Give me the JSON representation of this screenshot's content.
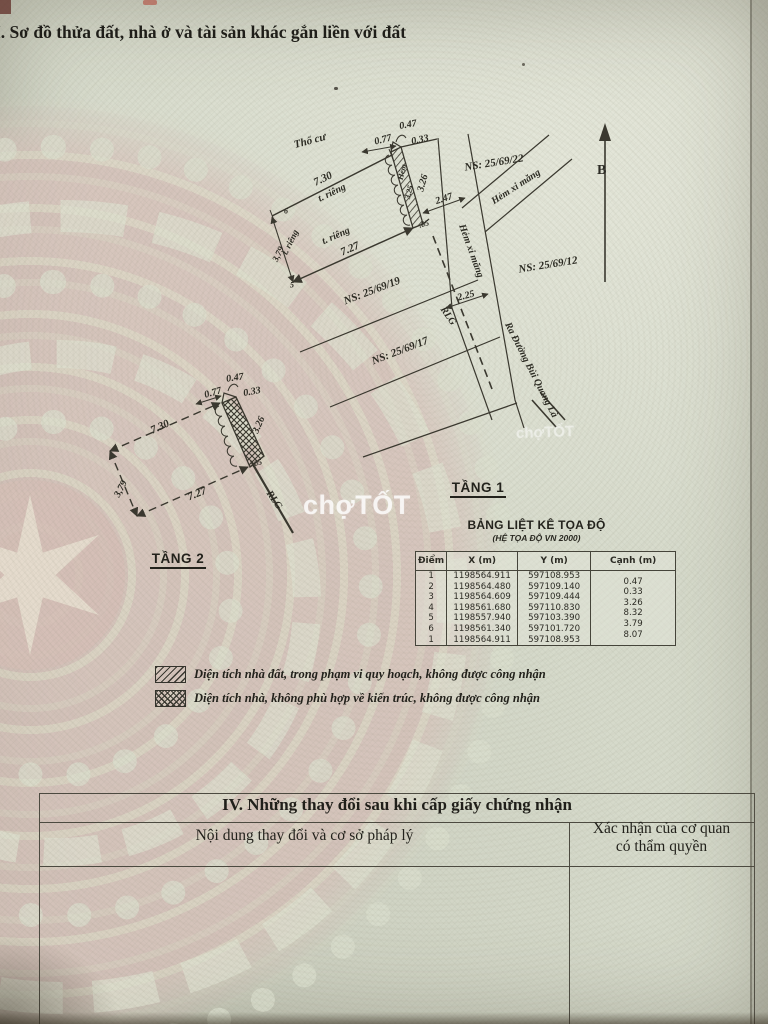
{
  "title_section1": "I. Sơ đồ thửa đất, nhà ở và tài sản khác gắn liền với đất",
  "north_label": "B",
  "floor1": {
    "label": "TẦNG 1",
    "annotations": [
      {
        "t": "Thổ cư",
        "x": 310,
        "y": 141,
        "r": -15,
        "fs": 11
      },
      {
        "t": "0.77",
        "x": 383,
        "y": 140,
        "r": -15,
        "fs": 10
      },
      {
        "t": "0.47",
        "x": 408,
        "y": 125,
        "r": -10,
        "fs": 10
      },
      {
        "t": "0.33",
        "x": 420,
        "y": 140,
        "r": -12,
        "fs": 10
      },
      {
        "t": "7.30",
        "x": 323,
        "y": 179,
        "r": -26,
        "fs": 11
      },
      {
        "t": "t. riêng",
        "x": 332,
        "y": 193,
        "r": -26,
        "fs": 10
      },
      {
        "t": "t. riêng",
        "x": 290,
        "y": 242,
        "r": -64,
        "fs": 9
      },
      {
        "t": "3,79",
        "x": 278,
        "y": 254,
        "r": -64,
        "fs": 9
      },
      {
        "t": "t. riêng",
        "x": 336,
        "y": 236,
        "r": -24,
        "fs": 10
      },
      {
        "t": "7.27",
        "x": 350,
        "y": 249,
        "r": -24,
        "fs": 11
      },
      {
        "t": "Hẻm",
        "x": 402,
        "y": 172,
        "r": -76,
        "fs": 8
      },
      {
        "t": "3.25",
        "x": 409,
        "y": 192,
        "r": -76,
        "fs": 8
      },
      {
        "t": "3.26",
        "x": 423,
        "y": 183,
        "r": -74,
        "fs": 10
      },
      {
        "t": "2.47",
        "x": 444,
        "y": 199,
        "r": -18,
        "fs": 10
      },
      {
        "t": ".05",
        "x": 424,
        "y": 224,
        "r": -15,
        "fs": 8
      },
      {
        "t": "NS: 25/69/19",
        "x": 372,
        "y": 291,
        "r": -21,
        "fs": 11
      },
      {
        "t": "NS: 25/69/17",
        "x": 400,
        "y": 351,
        "r": -21,
        "fs": 11
      },
      {
        "t": "NS: 25/69/22",
        "x": 494,
        "y": 163,
        "r": -9,
        "fs": 11
      },
      {
        "t": "NS: 25/69/12",
        "x": 548,
        "y": 265,
        "r": -9,
        "fs": 11
      },
      {
        "t": "Hẻm xi măng",
        "x": 516,
        "y": 187,
        "r": -33,
        "fs": 10
      },
      {
        "t": "Hẻm xi măng",
        "x": 471,
        "y": 251,
        "r": 70,
        "fs": 10
      },
      {
        "t": "2.25",
        "x": 466,
        "y": 296,
        "r": -15,
        "fs": 10
      },
      {
        "t": "RLG",
        "x": 448,
        "y": 316,
        "r": 55,
        "fs": 10
      },
      {
        "t": "Ra Đường Bùi Quang Là",
        "x": 531,
        "y": 370,
        "r": 63,
        "fs": 10
      },
      {
        "t": "6",
        "x": 286,
        "y": 211,
        "r": 0,
        "fs": 8
      },
      {
        "t": "5",
        "x": 292,
        "y": 285,
        "r": 0,
        "fs": 8
      }
    ]
  },
  "floor2": {
    "label": "TẦNG 2",
    "annotations": [
      {
        "t": "0.77",
        "x": 213,
        "y": 393,
        "r": -16,
        "fs": 10
      },
      {
        "t": "0.47",
        "x": 235,
        "y": 378,
        "r": -8,
        "fs": 10
      },
      {
        "t": "0.33",
        "x": 252,
        "y": 392,
        "r": -10,
        "fs": 10
      },
      {
        "t": "7.30",
        "x": 160,
        "y": 427,
        "r": -25,
        "fs": 11
      },
      {
        "t": "3.26",
        "x": 259,
        "y": 425,
        "r": -66,
        "fs": 10
      },
      {
        "t": ".05",
        "x": 257,
        "y": 463,
        "r": -15,
        "fs": 8
      },
      {
        "t": "3,79",
        "x": 121,
        "y": 489,
        "r": -62,
        "fs": 10
      },
      {
        "t": "7.27",
        "x": 197,
        "y": 494,
        "r": -22,
        "fs": 11
      },
      {
        "t": "RLG",
        "x": 274,
        "y": 500,
        "r": 55,
        "fs": 10
      }
    ]
  },
  "coord_table": {
    "title": "BẢNG LIỆT KÊ TỌA ĐỘ",
    "subtitle": "(HỆ TỌA ĐỘ VN 2000)",
    "headers": [
      "Điểm",
      "X (m)",
      "Y (m)",
      "Cạnh (m)"
    ],
    "rows": [
      [
        "1",
        "1198564.911",
        "597108.953",
        ""
      ],
      [
        "2",
        "1198564.480",
        "597109.140",
        "0.47"
      ],
      [
        "3",
        "1198564.609",
        "597109.444",
        "0.33"
      ],
      [
        "4",
        "1198561.680",
        "597110.830",
        "3.26"
      ],
      [
        "5",
        "1198557.940",
        "597103.390",
        "8.32"
      ],
      [
        "6",
        "1198561.340",
        "597101.720",
        "3.79"
      ],
      [
        "1",
        "1198564.911",
        "597108.953",
        "8.07"
      ]
    ]
  },
  "legend": {
    "items": [
      {
        "pattern": "diagonal",
        "text": "Diện tích nhà đất, trong phạm vi  quy hoạch, không được công nhận"
      },
      {
        "pattern": "cross",
        "text": "Diện tích nhà, không phù hợp về kiến trúc, không được công nhận"
      }
    ]
  },
  "section4": {
    "title": "IV. Những thay đổi sau khi cấp giấy chứng nhận",
    "col1": "Nội dung thay đổi và cơ sở pháp lý",
    "col2_line1": "Xác nhận của cơ quan",
    "col2_line2": "có thẩm quyền"
  },
  "watermark": {
    "text": "chợTỐT"
  },
  "colors": {
    "paper": "#d6dacb",
    "drum_pink": "#d7c1ba",
    "ink": "#3a382f",
    "accent_red": "#b34a3c"
  }
}
